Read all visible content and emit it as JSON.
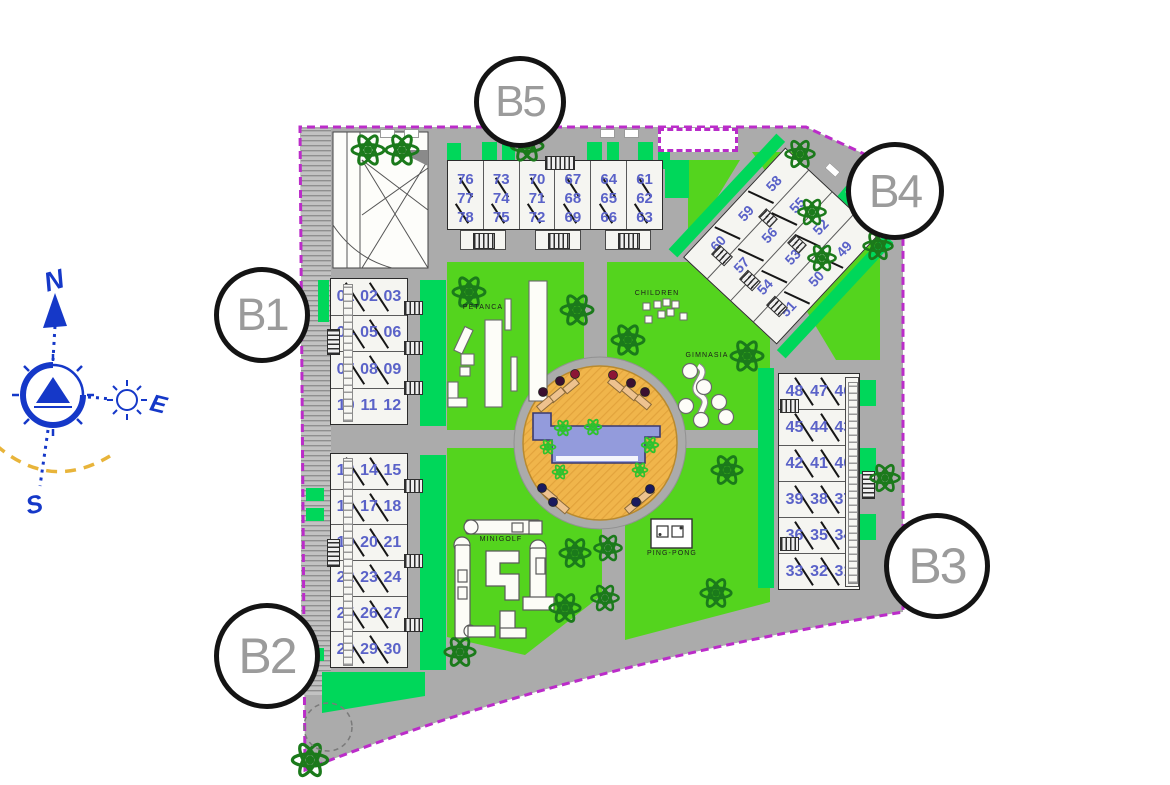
{
  "plan_title": "Residential complex site plan",
  "compass": {
    "north": "N",
    "east": "E",
    "south": "S"
  },
  "amenities": {
    "petanca": "PETANCA",
    "children": "CHILDREN",
    "gimnasia": "GIMNASIA",
    "minigolf": "MINIGOLF",
    "pingpong": "PING-PONG"
  },
  "buildings": {
    "b1": {
      "label": "B1",
      "rows": [
        [
          "01",
          "02",
          "03"
        ],
        [
          "04",
          "05",
          "06"
        ],
        [
          "07",
          "08",
          "09"
        ],
        [
          "10",
          "11",
          "12"
        ]
      ]
    },
    "b2": {
      "label": "B2",
      "rows": [
        [
          "13",
          "14",
          "15"
        ],
        [
          "16",
          "17",
          "18"
        ],
        [
          "19",
          "20",
          "21"
        ],
        [
          "22",
          "23",
          "24"
        ],
        [
          "25",
          "26",
          "27"
        ],
        [
          "28",
          "29",
          "30"
        ]
      ]
    },
    "b3": {
      "label": "B3",
      "rows": [
        [
          "48",
          "47",
          "46"
        ],
        [
          "45",
          "44",
          "43"
        ],
        [
          "42",
          "41",
          "40"
        ],
        [
          "39",
          "38",
          "37"
        ],
        [
          "36",
          "35",
          "34"
        ],
        [
          "33",
          "32",
          "31"
        ]
      ]
    },
    "b4": {
      "label": "B4",
      "rows": [
        [
          "60",
          "59",
          "58"
        ],
        [
          "57",
          "56",
          "55"
        ],
        [
          "54",
          "53",
          "52"
        ],
        [
          "51",
          "50",
          "49"
        ]
      ]
    },
    "b5": {
      "label": "B5",
      "cols": [
        [
          "76",
          "77",
          "78"
        ],
        [
          "73",
          "74",
          "75"
        ],
        [
          "70",
          "71",
          "72"
        ],
        [
          "67",
          "68",
          "69"
        ],
        [
          "64",
          "65",
          "66"
        ],
        [
          "61",
          "62",
          "63"
        ]
      ]
    }
  },
  "colors": {
    "boundary": "#bb2cc9",
    "road": "#ababab",
    "lawn": "#54d41e",
    "lawn_emerald": "#00d75a",
    "deck": "#f0b54b",
    "pool": "#939bdc",
    "unit_number": "#5a62c8",
    "compass_blue": "#1538c8",
    "sun_arc": "#e8b43a",
    "tree_green": "#1b7a1b"
  }
}
